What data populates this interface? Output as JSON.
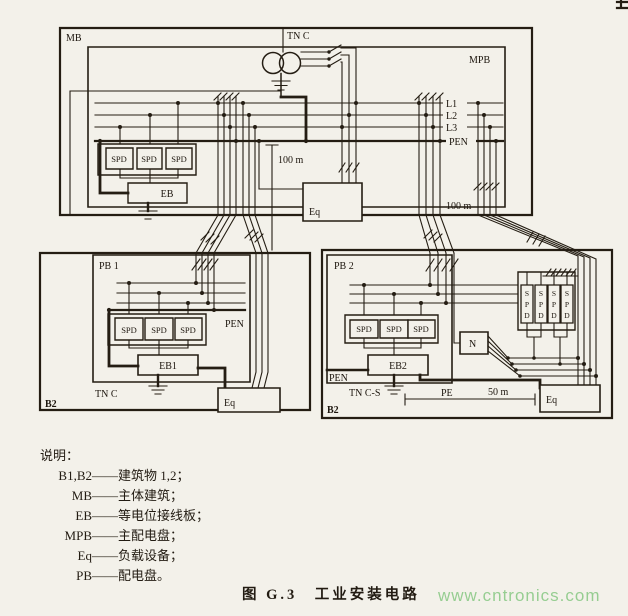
{
  "page": {
    "bg": "#f3f1ea",
    "ink": "#241d13",
    "watermark_color": "#7fc57c"
  },
  "top_building": {
    "mb": "MB",
    "tn_c": "TN C",
    "mpb": "MPB",
    "bus_labels": {
      "l1": "L1",
      "l2": "L2",
      "l3": "L3",
      "pen": "PEN"
    },
    "spd": "SPD",
    "eb": "EB",
    "eq": "Eq",
    "dist_left": "100 m",
    "dist_right": "100 m"
  },
  "building1": {
    "name": "B2",
    "panel": "PB 1",
    "pen": "PEN",
    "spd": "SPD",
    "eb": "EB1",
    "earthing": "TN C",
    "eq": "Eq"
  },
  "building2": {
    "name": "B2",
    "panel": "PB 2",
    "pen": "PEN",
    "spd": "SPD",
    "eb": "EB2",
    "earthing": "TN C-S",
    "pe": "PE",
    "dist": "50 m",
    "eq": "Eq",
    "n": "N",
    "spd_letters": [
      "S",
      "P",
      "D"
    ]
  },
  "legend": {
    "title": "说明：",
    "items": [
      {
        "term": "B1,B2",
        "dash": "——",
        "desc": "建筑物 1,2；"
      },
      {
        "term": "MB",
        "dash": "——",
        "desc": "主体建筑；"
      },
      {
        "term": "EB",
        "dash": "——",
        "desc": "等电位接线板；"
      },
      {
        "term": "MPB",
        "dash": "——",
        "desc": "主配电盘；"
      },
      {
        "term": "Eq",
        "dash": "——",
        "desc": "负载设备；"
      },
      {
        "term": "PB",
        "dash": "——",
        "desc": "配电盘。"
      }
    ]
  },
  "caption": "图 G.3　工业安装电路",
  "watermark": "www.cntronics.com"
}
